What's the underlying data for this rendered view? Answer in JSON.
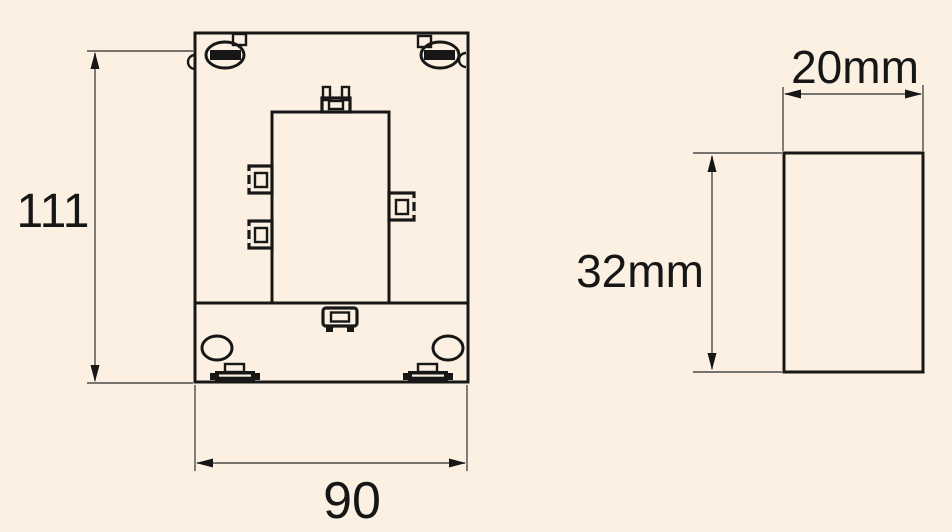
{
  "drawing": {
    "type": "technical-dimension-drawing",
    "background_color": "#fbf0e1",
    "colors": {
      "outline": "#171717",
      "dimension_line": "#4c4c4c",
      "text": "#161616"
    },
    "front_view": {
      "height_dimension": "111",
      "width_dimension": "90"
    },
    "side_view": {
      "depth_dimension": "20mm",
      "height_dimension": "32mm"
    }
  }
}
